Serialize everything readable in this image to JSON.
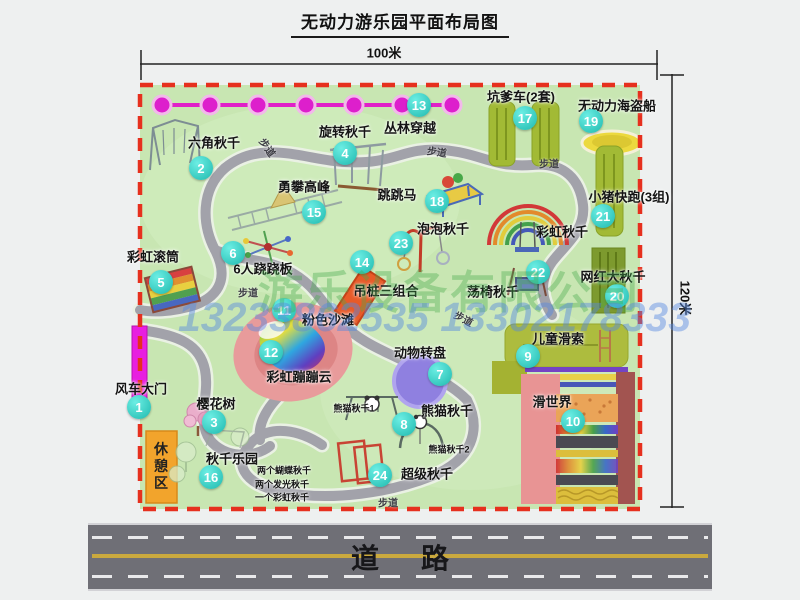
{
  "title": "无动力游乐园平面布局图",
  "dim_width": "100米",
  "dim_height": "120米",
  "road_label": "道路",
  "walkway": "步道",
  "watermark": {
    "company": "游乐设备有限公司",
    "phone": "13233862535 13302178333"
  },
  "extra": {
    "rainbow_swing": "彩虹秋千",
    "rest_area": "休憩区",
    "panda_1": "熊猫秋千1",
    "panda_2": "熊猫秋千2"
  },
  "items": [
    {
      "num": "1",
      "label": "风车大门"
    },
    {
      "num": "2",
      "label": "六角秋千"
    },
    {
      "num": "3",
      "label": "樱花树"
    },
    {
      "num": "4",
      "label": "旋转秋千"
    },
    {
      "num": "5",
      "label": "彩虹滚筒"
    },
    {
      "num": "6",
      "label": "6人跷跷板"
    },
    {
      "num": "7",
      "label": "动物转盘"
    },
    {
      "num": "8",
      "label": "熊猫秋千"
    },
    {
      "num": "9",
      "label": "儿童滑索"
    },
    {
      "num": "10",
      "label": "滑世界"
    },
    {
      "num": "11",
      "label": "粉色沙滩"
    },
    {
      "num": "12",
      "label": "彩虹蹦蹦云"
    },
    {
      "num": "13",
      "label": "丛林穿越"
    },
    {
      "num": "14",
      "label": "吊桩三组合"
    },
    {
      "num": "15",
      "label": "勇攀高峰"
    },
    {
      "num": "16",
      "label": "秋千乐园",
      "notes": [
        "两个蝴蝶秋千",
        "两个发光秋千",
        "一个彩虹秋千"
      ]
    },
    {
      "num": "17",
      "label": "坑爹车(2套)"
    },
    {
      "num": "18",
      "label": "跳跳马"
    },
    {
      "num": "19",
      "label": "无动力海盗船"
    },
    {
      "num": "20",
      "label": "网红大秋千"
    },
    {
      "num": "21",
      "label": "小猪快跑(3组)"
    },
    {
      "num": "22",
      "label": "荡椅秋千"
    },
    {
      "num": "23",
      "label": "泡泡秋千"
    },
    {
      "num": "24",
      "label": "超级秋千"
    }
  ],
  "colors": {
    "map_green": "#c8e6b2",
    "border_red": "#e6301e",
    "badge_cyan": "#1fb9ae",
    "gate_magenta": "#e81fe0",
    "road_gray": "#6f6f76",
    "beach_pink": "#e89b9b",
    "strip_olive": "#a2ba35",
    "rest_orange": "#f2a42c"
  }
}
